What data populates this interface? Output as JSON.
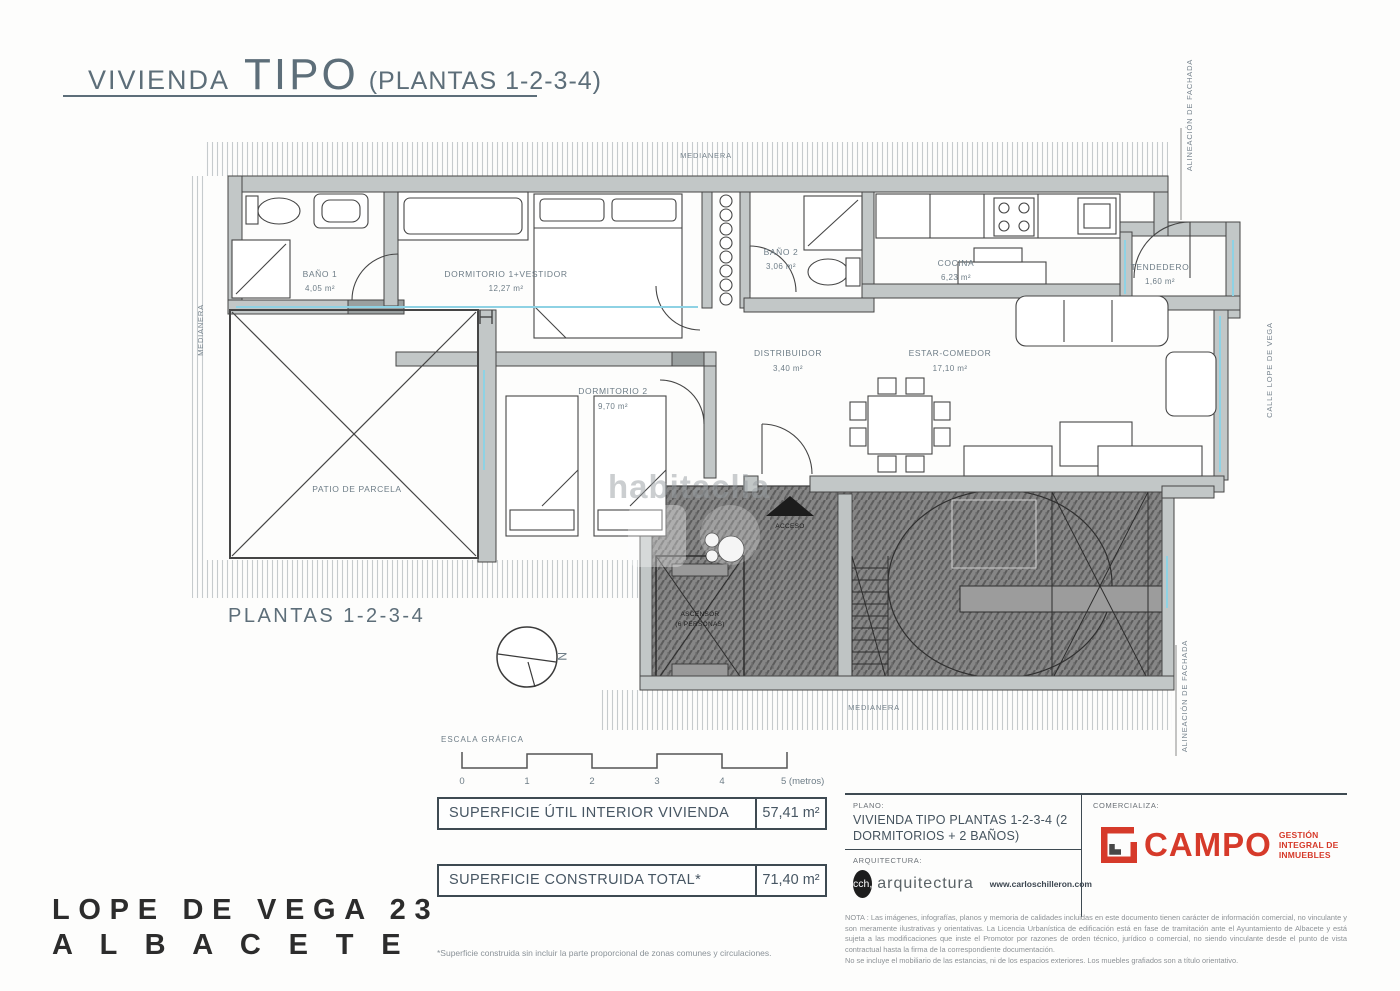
{
  "header": {
    "title_prefix": "VIVIENDA",
    "title_main": "TIPO",
    "title_suffix": "(PLANTAS 1-2-3-4)"
  },
  "plan": {
    "floor_label": "PLANTAS 1-2-3-4",
    "rooms": [
      {
        "name": "BAÑO 1",
        "area": "4,05 m²"
      },
      {
        "name": "DORMITORIO 1+VESTIDOR",
        "area": "12,27 m²"
      },
      {
        "name": "BAÑO 2",
        "area": "3,06 m²"
      },
      {
        "name": "COCINA",
        "area": "6,23 m²"
      },
      {
        "name": "TENDEDERO",
        "area": "1,60 m²"
      },
      {
        "name": "DISTRIBUIDOR",
        "area": "3,40 m²"
      },
      {
        "name": "ESTAR-COMEDOR",
        "area": "17,10 m²"
      },
      {
        "name": "DORMITORIO 2",
        "area": "9,70 m²"
      },
      {
        "name": "PATIO DE PARCELA",
        "area": ""
      },
      {
        "name": "ASCENSOR",
        "area": "(6 PERSONAS)"
      }
    ],
    "labels": {
      "acceso": "ACCESO"
    },
    "boundaries": {
      "medianera_top": "MEDIANERA",
      "medianera_left": "MEDIANERA",
      "medianera_bottom": "MEDIANERA",
      "alineacion_top": "ALINEACIÓN DE FACHADA",
      "alineacion_bottom": "ALINEACIÓN DE FACHADA",
      "calle": "CALLE LOPE DE VEGA"
    }
  },
  "scale_bar": {
    "label": "ESCALA GRÁFICA",
    "ticks": [
      "0",
      "1",
      "2",
      "3",
      "4"
    ],
    "end_tick": "5 (metros)"
  },
  "surface_tables": [
    {
      "label": "SUPERFICIE ÚTIL INTERIOR VIVIENDA",
      "value": "57,41 m²"
    },
    {
      "label": "SUPERFICIE CONSTRUIDA TOTAL*",
      "value": "71,40 m²"
    }
  ],
  "footnote": "*Superficie construida sin incluir la parte proporcional de zonas comunes y circulaciones.",
  "address": {
    "line1": "LOPE DE VEGA 23",
    "line2": "A L B A C E T E"
  },
  "title_block": {
    "plano_label": "PLANO:",
    "plano_value": "VIVIENDA TIPO PLANTAS 1-2-3-4 (2 DORMITORIOS + 2 BAÑOS)",
    "arquitectura_label": "ARQUITECTURA:",
    "arquitectura_logo": "cch,",
    "arquitectura_name": "arquitectura",
    "arquitectura_web": "www.carloschilleron.com",
    "comercializa_label": "COMERCIALIZA:",
    "brand_name": "CAMPO",
    "brand_tagline_1": "GESTIÓN",
    "brand_tagline_2": "INTEGRAL DE",
    "brand_tagline_3": "INMUEBLES",
    "nota_1": "NOTA : Las imágenes, infografías, planos y memoria de calidades incluidas en este documento tienen carácter de información comercial, no vinculante y son meramente ilustrativas y orientativas. La Licencia Urbanística de edificación está en fase de tramitación ante el Ayuntamiento de Albacete y está sujeta a las modificaciones que inste el Promotor por razones de orden técnico, jurídico o comercial, no siendo vinculante desde el punto de vista contractual hasta la firma de la correspondiente documentación.",
    "nota_2": "No se incluye el mobiliario de las estancias, ni de los espacios exteriores. Los muebles grafiados son a título orientativo."
  },
  "watermark": {
    "text": "habitaclia"
  },
  "colors": {
    "accent_red": "#d63a2a",
    "plan_line": "#454545",
    "cyan": "#8ed2e4",
    "wall_fill": "#c2c7c7"
  }
}
